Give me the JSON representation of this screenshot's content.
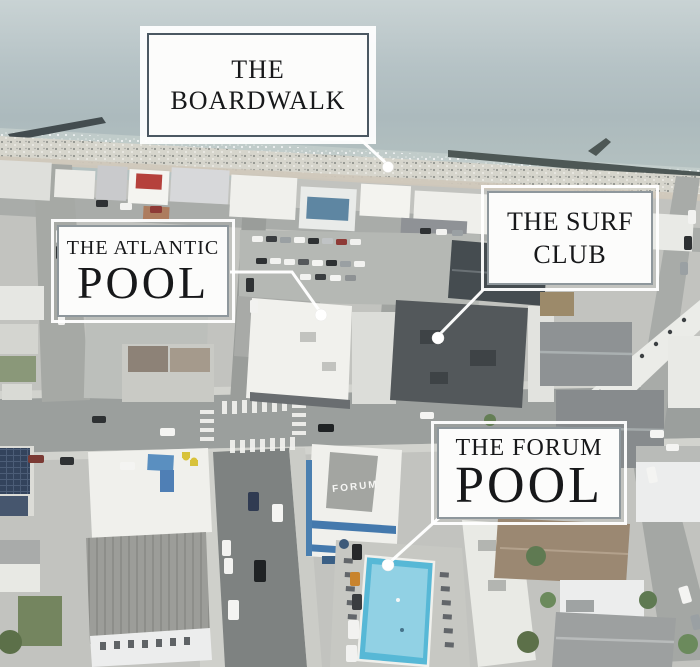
{
  "meta": {
    "description": "Aerial drone photo of an oceanfront resort town with four labeled locations"
  },
  "callouts": {
    "boardwalk": {
      "line1": "THE",
      "line2": "BOARDWALK"
    },
    "atlantic_pool": {
      "line1": "THE ATLANTIC",
      "line2": "POOL"
    },
    "surf_club": {
      "line1": "THE SURF",
      "line2": "CLUB"
    },
    "forum_pool": {
      "line1": "THE FORUM",
      "line2": "POOL"
    }
  },
  "scene": {
    "forum_building_sign": "FORUM"
  },
  "colors": {
    "ocean": "#aebcbf",
    "sand": "#d6d5cc",
    "atlantic_pool_water": "#4fb6d2",
    "forum_pool_water": "#57b8d6",
    "forum_accent_blue": "#4479ad",
    "callout_border_dark": "#4b5862",
    "callout_border_light": "#8e979c",
    "label_text": "#17181a",
    "leader_line": "#ffffff"
  }
}
